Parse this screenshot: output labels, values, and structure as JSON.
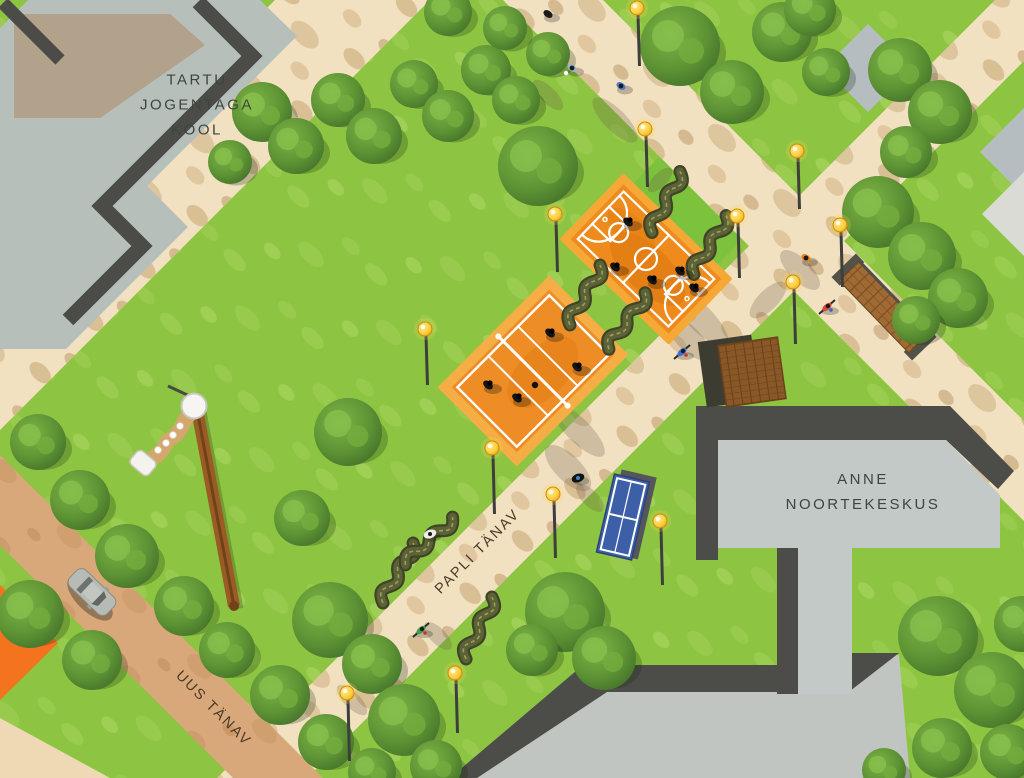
{
  "title": "Park site plan illustration",
  "labels": {
    "school": [
      "TARTU",
      "JOGENTAGA",
      "KOOL"
    ],
    "youth_center": [
      "ANNE",
      "NOORTEKESKUS"
    ],
    "street_papli": "PAPLI TÄNAV",
    "street_uus": "UUS TÄNAV"
  },
  "palette": {
    "grass": "#8dc542",
    "grass_light": "#a7d45c",
    "lawn_patch": "#7cc23c",
    "path_sand": "#f2e1c0",
    "path_blotch": "#d3b68a",
    "road": "#d9a87a",
    "building_gray": "#c3c9c6",
    "school_gray": "#b6bfba",
    "roof_dark": "#4c4c49",
    "court_orange": "#ef8a1d",
    "court_border": "#f5a93f",
    "court_line": "#ffffff",
    "table_tennis_blue": "#3d5fa8",
    "wood_deck": "#8a5827",
    "brick_bench": "#a06a34",
    "lamp_yellow": "#ffcf3f",
    "tree_green": "#5d9334",
    "orange_patch": "#f4731f",
    "bench_olive": "#3f4427"
  },
  "features": {
    "trees": [
      [
        262,
        112,
        30
      ],
      [
        296,
        146,
        28
      ],
      [
        338,
        100,
        27
      ],
      [
        374,
        136,
        28
      ],
      [
        414,
        84,
        24
      ],
      [
        448,
        116,
        26
      ],
      [
        486,
        70,
        25
      ],
      [
        516,
        100,
        24
      ],
      [
        548,
        54,
        22
      ],
      [
        230,
        162,
        22
      ],
      [
        448,
        12,
        24
      ],
      [
        505,
        28,
        22
      ],
      [
        680,
        46,
        40
      ],
      [
        732,
        92,
        32
      ],
      [
        782,
        32,
        30
      ],
      [
        826,
        72,
        24
      ],
      [
        810,
        10,
        26
      ],
      [
        900,
        70,
        32
      ],
      [
        940,
        112,
        32
      ],
      [
        906,
        152,
        26
      ],
      [
        878,
        212,
        36
      ],
      [
        922,
        256,
        34
      ],
      [
        958,
        298,
        30
      ],
      [
        916,
        320,
        24
      ],
      [
        538,
        166,
        40
      ],
      [
        348,
        432,
        34
      ],
      [
        302,
        518,
        28
      ],
      [
        330,
        620,
        38
      ],
      [
        372,
        664,
        30
      ],
      [
        404,
        720,
        36
      ],
      [
        436,
        766,
        26
      ],
      [
        565,
        612,
        40
      ],
      [
        604,
        658,
        32
      ],
      [
        532,
        650,
        26
      ],
      [
        938,
        636,
        40
      ],
      [
        992,
        690,
        38
      ],
      [
        1022,
        624,
        28
      ],
      [
        942,
        748,
        30
      ],
      [
        1008,
        752,
        28
      ],
      [
        884,
        770,
        22
      ],
      [
        38,
        442,
        28
      ],
      [
        80,
        500,
        30
      ],
      [
        127,
        556,
        32
      ],
      [
        184,
        606,
        30
      ],
      [
        227,
        650,
        28
      ],
      [
        280,
        695,
        30
      ],
      [
        326,
        742,
        28
      ],
      [
        372,
        772,
        24
      ],
      [
        30,
        614,
        34
      ],
      [
        92,
        660,
        30
      ]
    ],
    "lamps": [
      [
        555,
        214,
        58
      ],
      [
        645,
        129,
        58
      ],
      [
        737,
        216,
        62
      ],
      [
        797,
        151,
        58
      ],
      [
        840,
        225,
        62
      ],
      [
        793,
        282,
        62
      ],
      [
        425,
        329,
        56
      ],
      [
        492,
        448,
        66
      ],
      [
        553,
        494,
        64
      ],
      [
        660,
        521,
        64
      ],
      [
        455,
        673,
        60
      ],
      [
        347,
        693,
        68
      ],
      [
        637,
        8,
        58
      ]
    ],
    "wavy_benches": [
      [
        666,
        202,
        -48
      ],
      [
        710,
        245,
        -44
      ],
      [
        585,
        295,
        -46
      ],
      [
        627,
        321,
        -40
      ],
      [
        398,
        573,
        -46
      ],
      [
        479,
        628,
        -50
      ],
      [
        429,
        541,
        -28
      ]
    ],
    "smudges": [
      [
        615,
        120,
        30,
        11,
        45
      ],
      [
        548,
        95,
        20,
        8,
        45
      ],
      [
        688,
        338,
        30,
        12,
        45
      ],
      [
        568,
        468,
        30,
        13,
        45
      ],
      [
        768,
        300,
        24,
        10,
        -45
      ],
      [
        800,
        270,
        26,
        11,
        45
      ],
      [
        352,
        700,
        20,
        8,
        45
      ],
      [
        438,
        636,
        18,
        8,
        45
      ],
      [
        590,
        498,
        18,
        8,
        45
      ],
      [
        660,
        180,
        16,
        7,
        -45
      ],
      [
        700,
        318,
        38,
        13,
        45
      ],
      [
        578,
        430,
        36,
        12,
        45
      ]
    ],
    "people": {
      "court_players": [
        [
          628,
          222
        ],
        [
          615,
          267
        ],
        [
          652,
          280
        ],
        [
          680,
          271
        ],
        [
          694,
          288
        ],
        [
          550,
          333
        ],
        [
          577,
          367
        ],
        [
          488,
          385
        ],
        [
          517,
          398
        ]
      ],
      "walkers": [
        [
          548,
          14,
          "#1c1c1c"
        ],
        [
          572,
          68,
          "#9db3c4",
          "#ffffff"
        ],
        [
          621,
          86,
          "#4d7fd0"
        ],
        [
          806,
          258,
          "#e8821e"
        ]
      ],
      "cyclists": [
        [
          827,
          307,
          "#d8453a",
          "#3b5fbf"
        ],
        [
          682,
          352,
          "#3b6ed6",
          "#cc3322"
        ],
        [
          421,
          630,
          "#3f9e4d",
          "#cc3322"
        ]
      ],
      "dogs": [
        [
          578,
          478,
          "#121212",
          "#4a7fd0"
        ],
        [
          430,
          534,
          "#f0ede8",
          "#1a1a1a"
        ]
      ],
      "ball": [
        535,
        385
      ]
    }
  }
}
